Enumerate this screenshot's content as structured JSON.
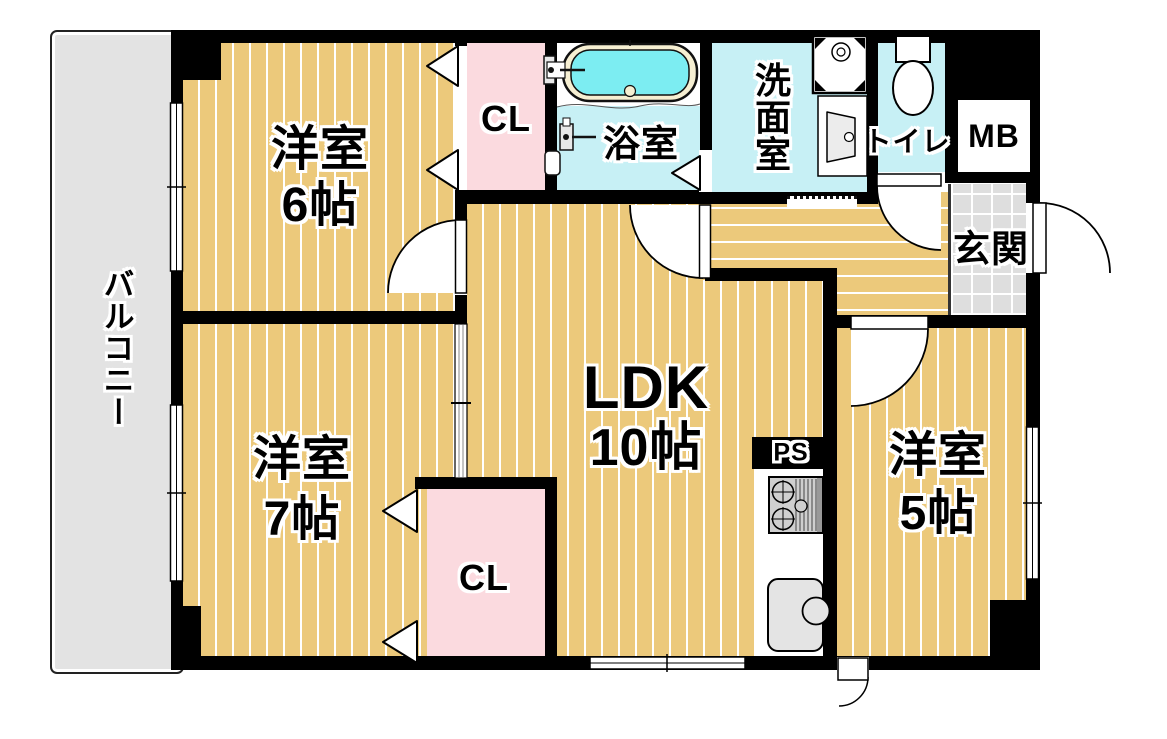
{
  "floorplan": {
    "balcony": {
      "label": "バルコニー"
    },
    "bedroom_north": {
      "name": "洋室",
      "size": "6帖"
    },
    "bedroom_southwest": {
      "name": "洋室",
      "size": "7帖"
    },
    "bedroom_east": {
      "name": "洋室",
      "size": "5帖"
    },
    "ldk": {
      "name": "LDK",
      "size": "10帖"
    },
    "bathroom": {
      "label": "浴室"
    },
    "washroom": {
      "label": "洗面室"
    },
    "toilet": {
      "label": "トイレ"
    },
    "entrance": {
      "label": "玄関"
    },
    "closet_north": {
      "label": "CL"
    },
    "closet_south": {
      "label": "CL"
    },
    "meter_box": {
      "label": "MB"
    },
    "pipe_shaft": {
      "label": "PS"
    },
    "icons": {
      "bathtub": "bathtub-icon",
      "bath_faucet": "bath-faucet-icon",
      "shower_mixer": "shower-mixer-icon",
      "toilet": "toilet-icon",
      "washing_machine_pan": "washing-machine-pan-icon",
      "vanity_sink": "vanity-sink-icon",
      "stove": "stove-icon",
      "kitchen_sink": "kitchen-sink-icon"
    },
    "colors": {
      "wall": "#000000",
      "wood_floor": "#ECC97B",
      "floor_stripe": "#FFFFFF",
      "closet": "#FBDADF",
      "wet_area_floor": "#C7F0F5",
      "water": "#7CEDF2",
      "bathtub_rim": "#F6EFD2",
      "balcony": "#E3E3E3",
      "entrance_tile": "#DEDEDE"
    }
  }
}
